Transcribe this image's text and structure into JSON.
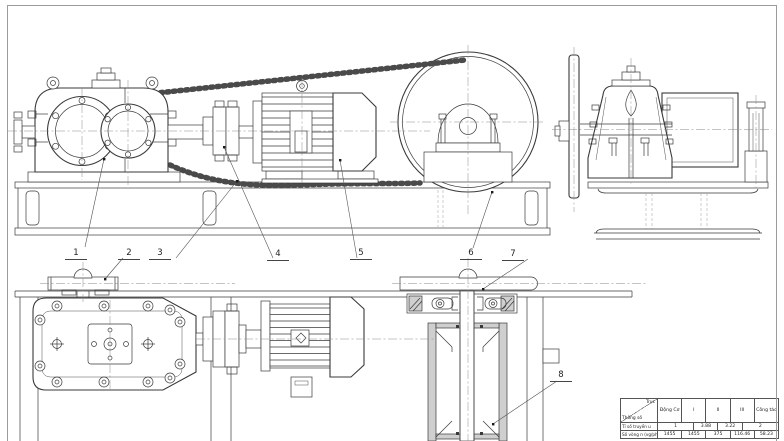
{
  "sheet": {
    "kind": "mechanical-assembly-drawing",
    "background": "#ffffff",
    "border_color": "#9c9c9c",
    "line_color": "#3a3a3a"
  },
  "callouts": [
    {
      "number": "1",
      "points_to": "gearbox"
    },
    {
      "number": "2",
      "points_to": "drive-sprocket"
    },
    {
      "number": "3",
      "points_to": "roller-chain"
    },
    {
      "number": "4",
      "points_to": "coupling"
    },
    {
      "number": "5",
      "points_to": "electric-motor"
    },
    {
      "number": "6",
      "points_to": "chain-wheel"
    },
    {
      "number": "7",
      "points_to": "shaft-bearing-block"
    },
    {
      "number": "8",
      "points_to": "frame-channel"
    }
  ],
  "spec_table": {
    "corner_top": "Trục",
    "corner_bottom": "Thông số",
    "columns": [
      "Động Cơ",
      "I",
      "II",
      "III",
      "Công tác"
    ],
    "rows": [
      {
        "label": "Tỉ số truyền u",
        "values": [
          "1",
          "3.88",
          "3.22",
          "2"
        ]
      },
      {
        "label": "Số vòng n (vg/ph)",
        "values": [
          "1455",
          "1455",
          "375",
          "116.46",
          "58.23"
        ]
      }
    ]
  }
}
